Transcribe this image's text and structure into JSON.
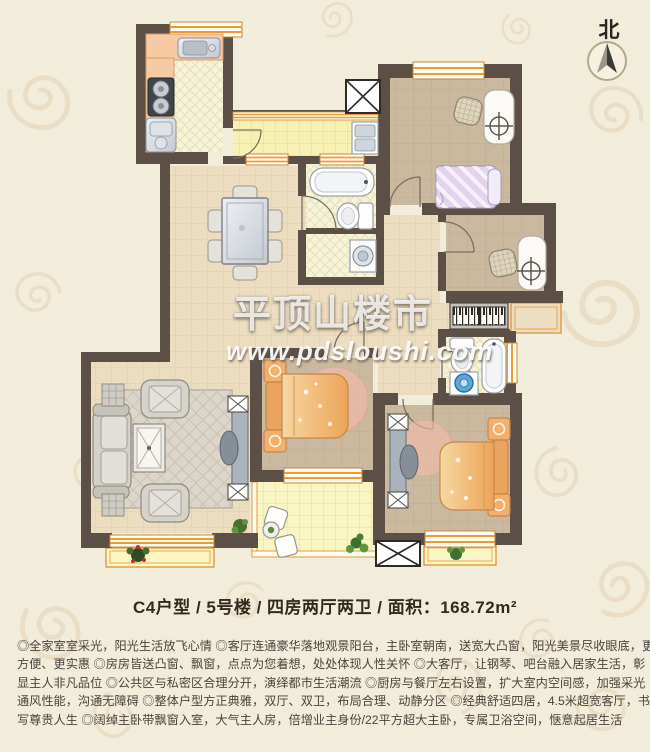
{
  "header": {
    "north_label": "北"
  },
  "watermark": {
    "brand": "平顶山楼市",
    "url": "www.pdsloushi.com"
  },
  "summary": {
    "title": "C4户型 / 5号楼 / 四房两厅两卫 / 面积：168.72m²"
  },
  "description": {
    "lines": [
      "◎全家室室采光，阳光生活放飞心情 ◎客厅连通豪华落地观景阳台，主卧室朝南，送宽大凸窗，阳光美景尽收眼底，更",
      "方便、更实惠 ◎房房皆送凸窗、飘窗，点点为您着想，处处体现人性关怀 ◎大客厅，让钢琴、吧台融入居家生活，彰",
      "显主人非凡品位 ◎公共区与私密区合理分开，演绎都市生活潮流 ◎厨房与餐厅左右设置，扩大室内空间感，加强采光",
      "通风性能，沟通无障碍 ◎整体户型方正典雅，双厅、双卫，布局合理、动静分区 ◎经典舒适四居，4.5米超宽客厅，书",
      "写尊贵人生 ◎阔绰主卧带飘窗入室，大气主人房，倍增业主身份/22平方超大主卧，专属卫浴空间，惬意起居生活"
    ]
  },
  "palette": {
    "background": "#f2ecdb",
    "wall": "#5b4f46",
    "window_accent": "#e8922e",
    "floor_public": "#ecdcc0",
    "floor_bedroom": "#cbb99f",
    "floor_tile": "#f6f3d9",
    "floor_corridor": "#f8f1b4",
    "floor_balcony": "#faf6c4",
    "counter_peach": "#f6cba3",
    "bed_orange": "#eca458",
    "bed_lavender": "#e3d3ec",
    "watermark": "#ffffff"
  }
}
